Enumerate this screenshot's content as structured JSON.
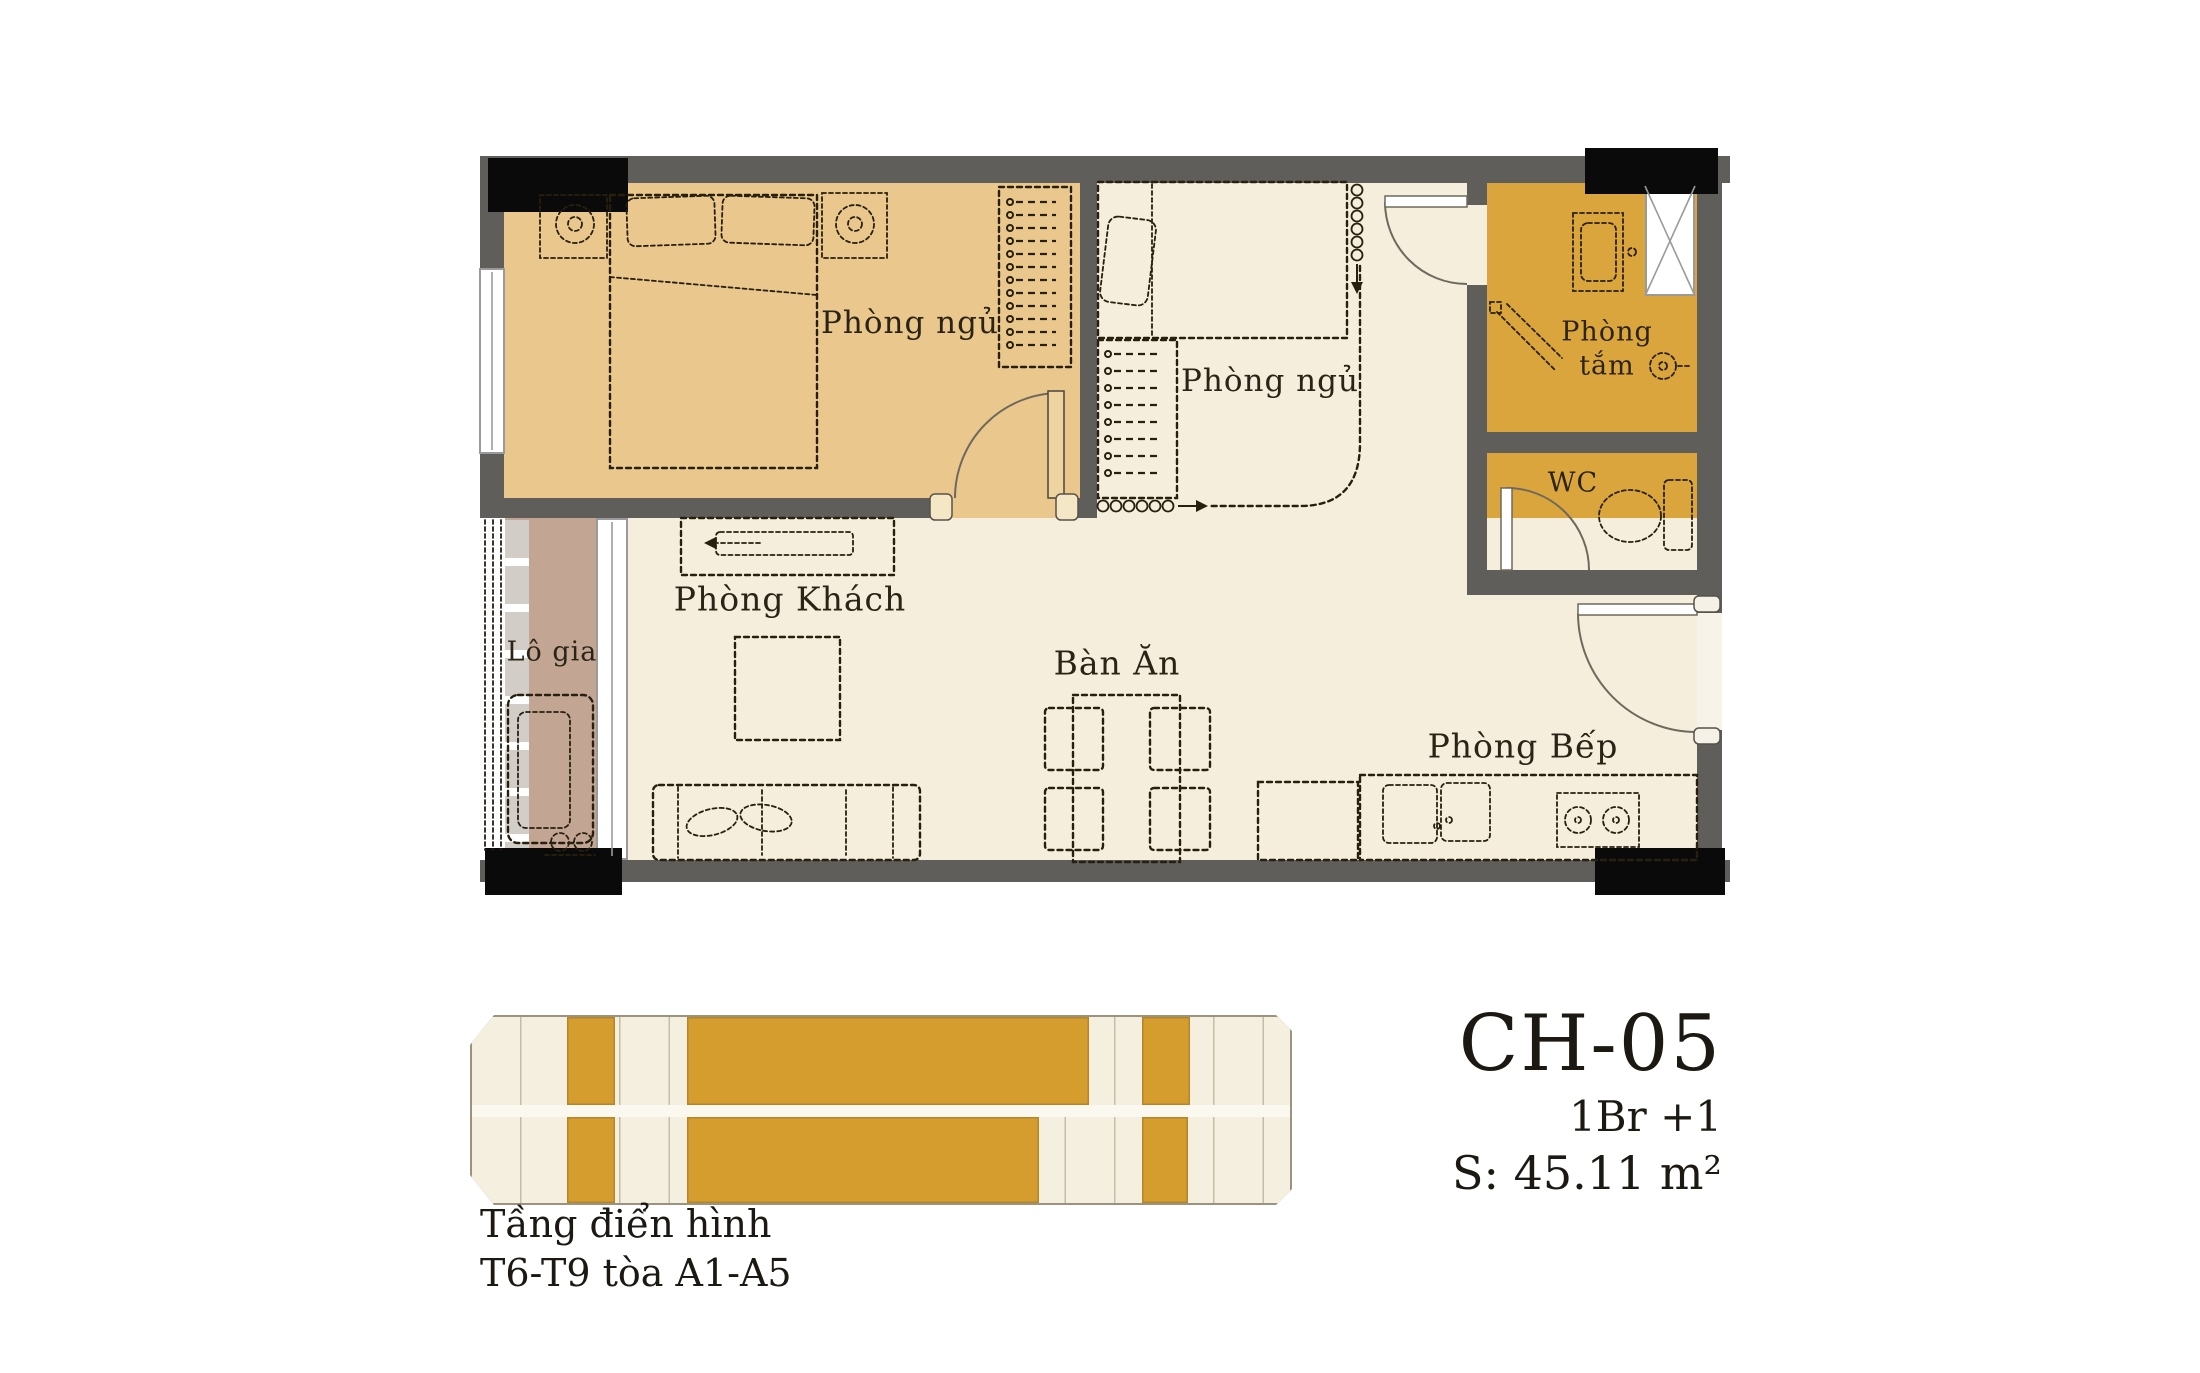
{
  "plan": {
    "rooms": {
      "bedroom1": "Phòng ngủ",
      "bedroom2": "Phòng ngủ",
      "bathroom_line1": "Phòng",
      "bathroom_line2": "tắm",
      "wc": "WC",
      "loggia": "Lô gia",
      "living": "Phòng Khách",
      "dining": "Bàn Ăn",
      "kitchen": "Phòng Bếp"
    }
  },
  "unit_info": {
    "code": "CH-05",
    "layout_type": "1Br +1",
    "area": "S: 45.11 m²"
  },
  "caption": {
    "line1": "Tầng điển hình",
    "line2": "T6-T9 tòa A1-A5"
  },
  "colors": {
    "tan": "#eac88d",
    "cream": "#f5eedd",
    "gold": "#dba53e",
    "mauve": "#c3a593",
    "wall": "#5f5e5b",
    "column": "#0a0a0a",
    "ink": "#27200f",
    "strip_bg": "#f4efde",
    "strip_line": "#9a9380",
    "strip_gold": "#d59d2e",
    "corridor": "#fbf8ef",
    "text": "#2b2416"
  },
  "floor_strip": {
    "highlights": [
      {
        "row": "top",
        "left": 97,
        "width": 48
      },
      {
        "row": "top",
        "left": 217,
        "width": 402
      },
      {
        "row": "top",
        "left": 672,
        "width": 48
      },
      {
        "row": "bottom",
        "left": 97,
        "width": 48
      },
      {
        "row": "bottom",
        "left": 217,
        "width": 352
      },
      {
        "row": "bottom",
        "left": 672,
        "width": 46
      }
    ]
  }
}
